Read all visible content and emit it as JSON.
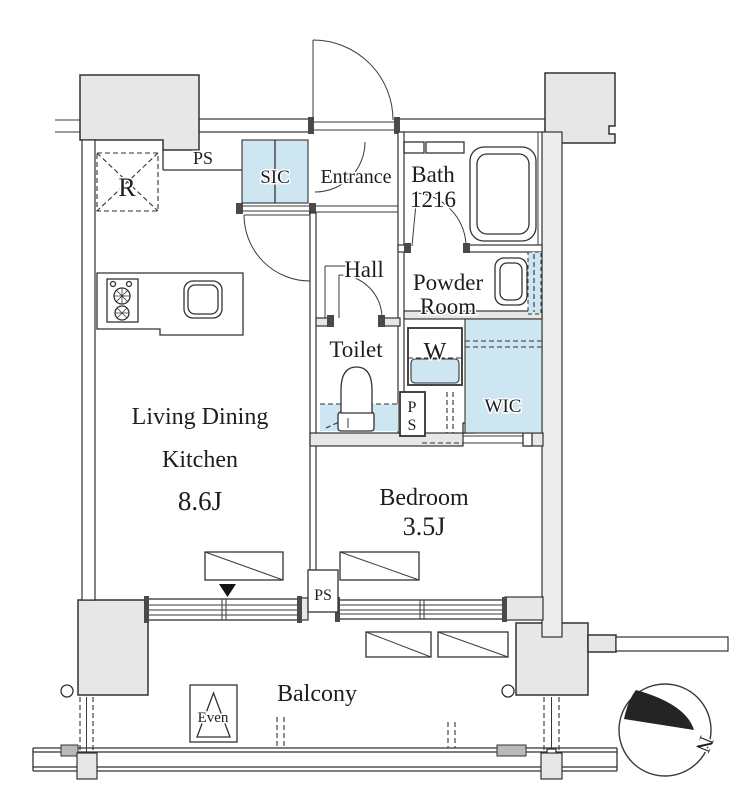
{
  "plan": {
    "type": "apartment-floor-plan",
    "rooms": {
      "ldk": {
        "line1": "Living Dining",
        "line2": "Kitchen",
        "size": "8.6J"
      },
      "bedroom": {
        "name": "Bedroom",
        "size": "3.5J"
      },
      "bath": {
        "name": "Bath",
        "size": "1216"
      },
      "powder": {
        "line1": "Powder",
        "line2": "Room"
      },
      "toilet": {
        "name": "Toilet"
      },
      "hall": {
        "name": "Hall"
      },
      "entrance": {
        "name": "Entrance"
      },
      "sic": {
        "name": "SIC"
      },
      "wic": {
        "name": "WIC"
      },
      "balcony": {
        "name": "Balcony"
      }
    },
    "fixtures": {
      "fridge": "R",
      "washer": "W",
      "ps_top": "PS",
      "ps_mid_p": "P",
      "ps_mid_s": "S",
      "ps_bottom": "PS",
      "hatch": "Even"
    },
    "compass": {
      "north": "N"
    },
    "colors": {
      "line": "#323232",
      "wall_fill": "#e7e7e7",
      "closet_blue": "#cee6f2",
      "background": "#ffffff"
    }
  }
}
